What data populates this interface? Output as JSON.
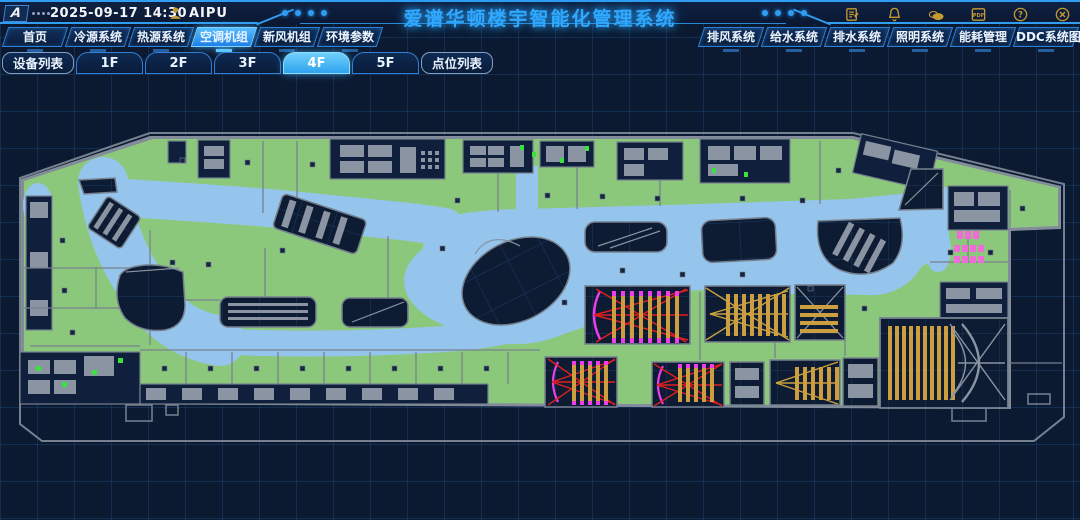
{
  "header": {
    "logo_text": "A",
    "datetime": "2025-09-17 14:30",
    "user_name": "AIPU",
    "title": "爱谱华顿楼宇智能化管理系统",
    "pdf_icon_label": "PDF",
    "icon_names": [
      "log-icon",
      "alarm-bell-icon",
      "weather-cloud-icon",
      "pdf-export-icon",
      "help-icon",
      "close-icon"
    ]
  },
  "primary_nav": {
    "left": [
      {
        "label": "首页",
        "active": false
      },
      {
        "label": "冷源系统",
        "active": false
      },
      {
        "label": "热源系统",
        "active": false
      },
      {
        "label": "空调机组",
        "active": true
      },
      {
        "label": "新风机组",
        "active": false
      },
      {
        "label": "环境参数",
        "active": false
      }
    ],
    "right": [
      {
        "label": "排风系统",
        "active": false
      },
      {
        "label": "给水系统",
        "active": false
      },
      {
        "label": "排水系统",
        "active": false
      },
      {
        "label": "照明系统",
        "active": false
      },
      {
        "label": "能耗管理",
        "active": false
      },
      {
        "label": "DDC系统图",
        "active": false
      }
    ]
  },
  "floor_nav": {
    "device_list": "设备列表",
    "floors": [
      {
        "label": "1F",
        "active": false
      },
      {
        "label": "2F",
        "active": false
      },
      {
        "label": "3F",
        "active": false
      },
      {
        "label": "4F",
        "active": true
      },
      {
        "label": "5F",
        "active": false
      }
    ],
    "point_list": "点位列表"
  },
  "plan": {
    "floor": "4F",
    "type": "shopping-mall-floor-plan",
    "palette": {
      "room_green": "#8cc87c",
      "corridor_blue": "#95c5ec",
      "void_navy": "#0d1b33",
      "wall_gray": "#828c9a",
      "cinema_seat_gold": "#cc9e3f",
      "seat_cap_magenta": "#ee3cee",
      "sightline_red": "#df2020",
      "toilet_pink": "#f06ad8",
      "fixture_green": "#3ae23e",
      "accent_blue": "#2f9df2"
    }
  }
}
